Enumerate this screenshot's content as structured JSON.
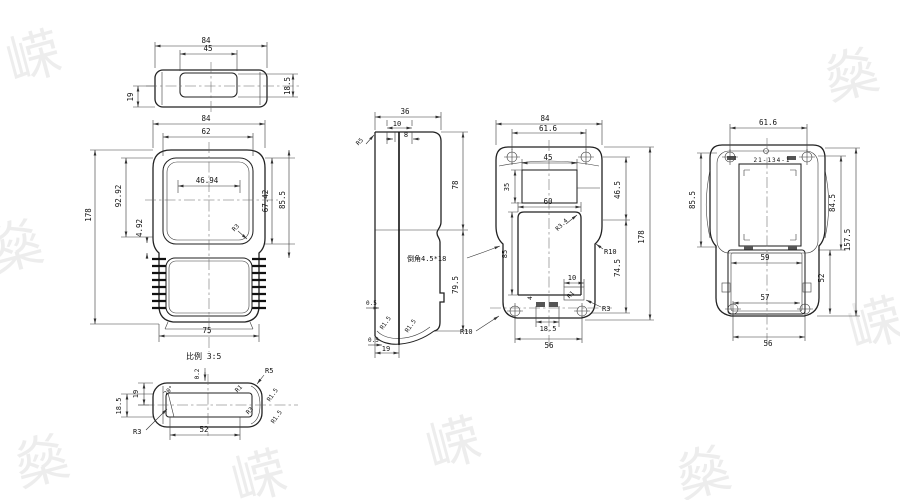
{
  "notes": {
    "scale": "比例 3:5",
    "chamfer": "倒角4.5*18",
    "part_no": "21-134-1"
  },
  "watermark": {
    "g1": "嵘",
    "g2": "燊"
  },
  "top": {
    "w": "84",
    "inner_w": "45",
    "h": "19",
    "inner_h": "18.5"
  },
  "front": {
    "w": "84",
    "win_w": "62",
    "flat_w": "46.94",
    "total_h": "178",
    "body_h": "92.92",
    "gap": "4.92",
    "win_h": "67.42",
    "sec_h": "85.5",
    "grip_w": "75",
    "r_corner": "R3"
  },
  "side": {
    "depth": "36",
    "boss_w": "10",
    "boss_inner": "8",
    "r_top": "R5",
    "upper_h": "78",
    "lower_h": "79.5",
    "wall_a": "0.5",
    "wall_b": "0.5",
    "r_a": "R1.5",
    "r_b": "R1.5",
    "base_w": "19"
  },
  "inside": {
    "w": "84",
    "hole_span": "61.6",
    "win_w": "45",
    "win_h": "35",
    "open_w": "60",
    "r_open": "R3.4",
    "open_h": "85",
    "upper_h": "46.5",
    "r_side": "R10",
    "lower_h": "74.5",
    "total_h": "178",
    "slot_span": "10",
    "r_slot": "R1",
    "r_boss": "R3",
    "slot_w": "4",
    "slot_off": "18.5",
    "hole_span_b": "56",
    "r_corner": "R10"
  },
  "back": {
    "hole_span": "61.6",
    "panel_h": "85.5",
    "panel_h_r": "84.5",
    "total_h": "157.5",
    "batt_w": "59",
    "batt_h": "52",
    "batt_w_b": "57",
    "hole_span_b": "56"
  },
  "detail": {
    "h": "19",
    "inner_h": "18.5",
    "step": "0.2",
    "draft": "20°",
    "r_in": "R1",
    "r_a": "R3",
    "r_end": "R5",
    "r_lip_a": "R1.5",
    "r_lip_b": "R1.5",
    "r_b": "R3",
    "cavity_w": "52"
  }
}
